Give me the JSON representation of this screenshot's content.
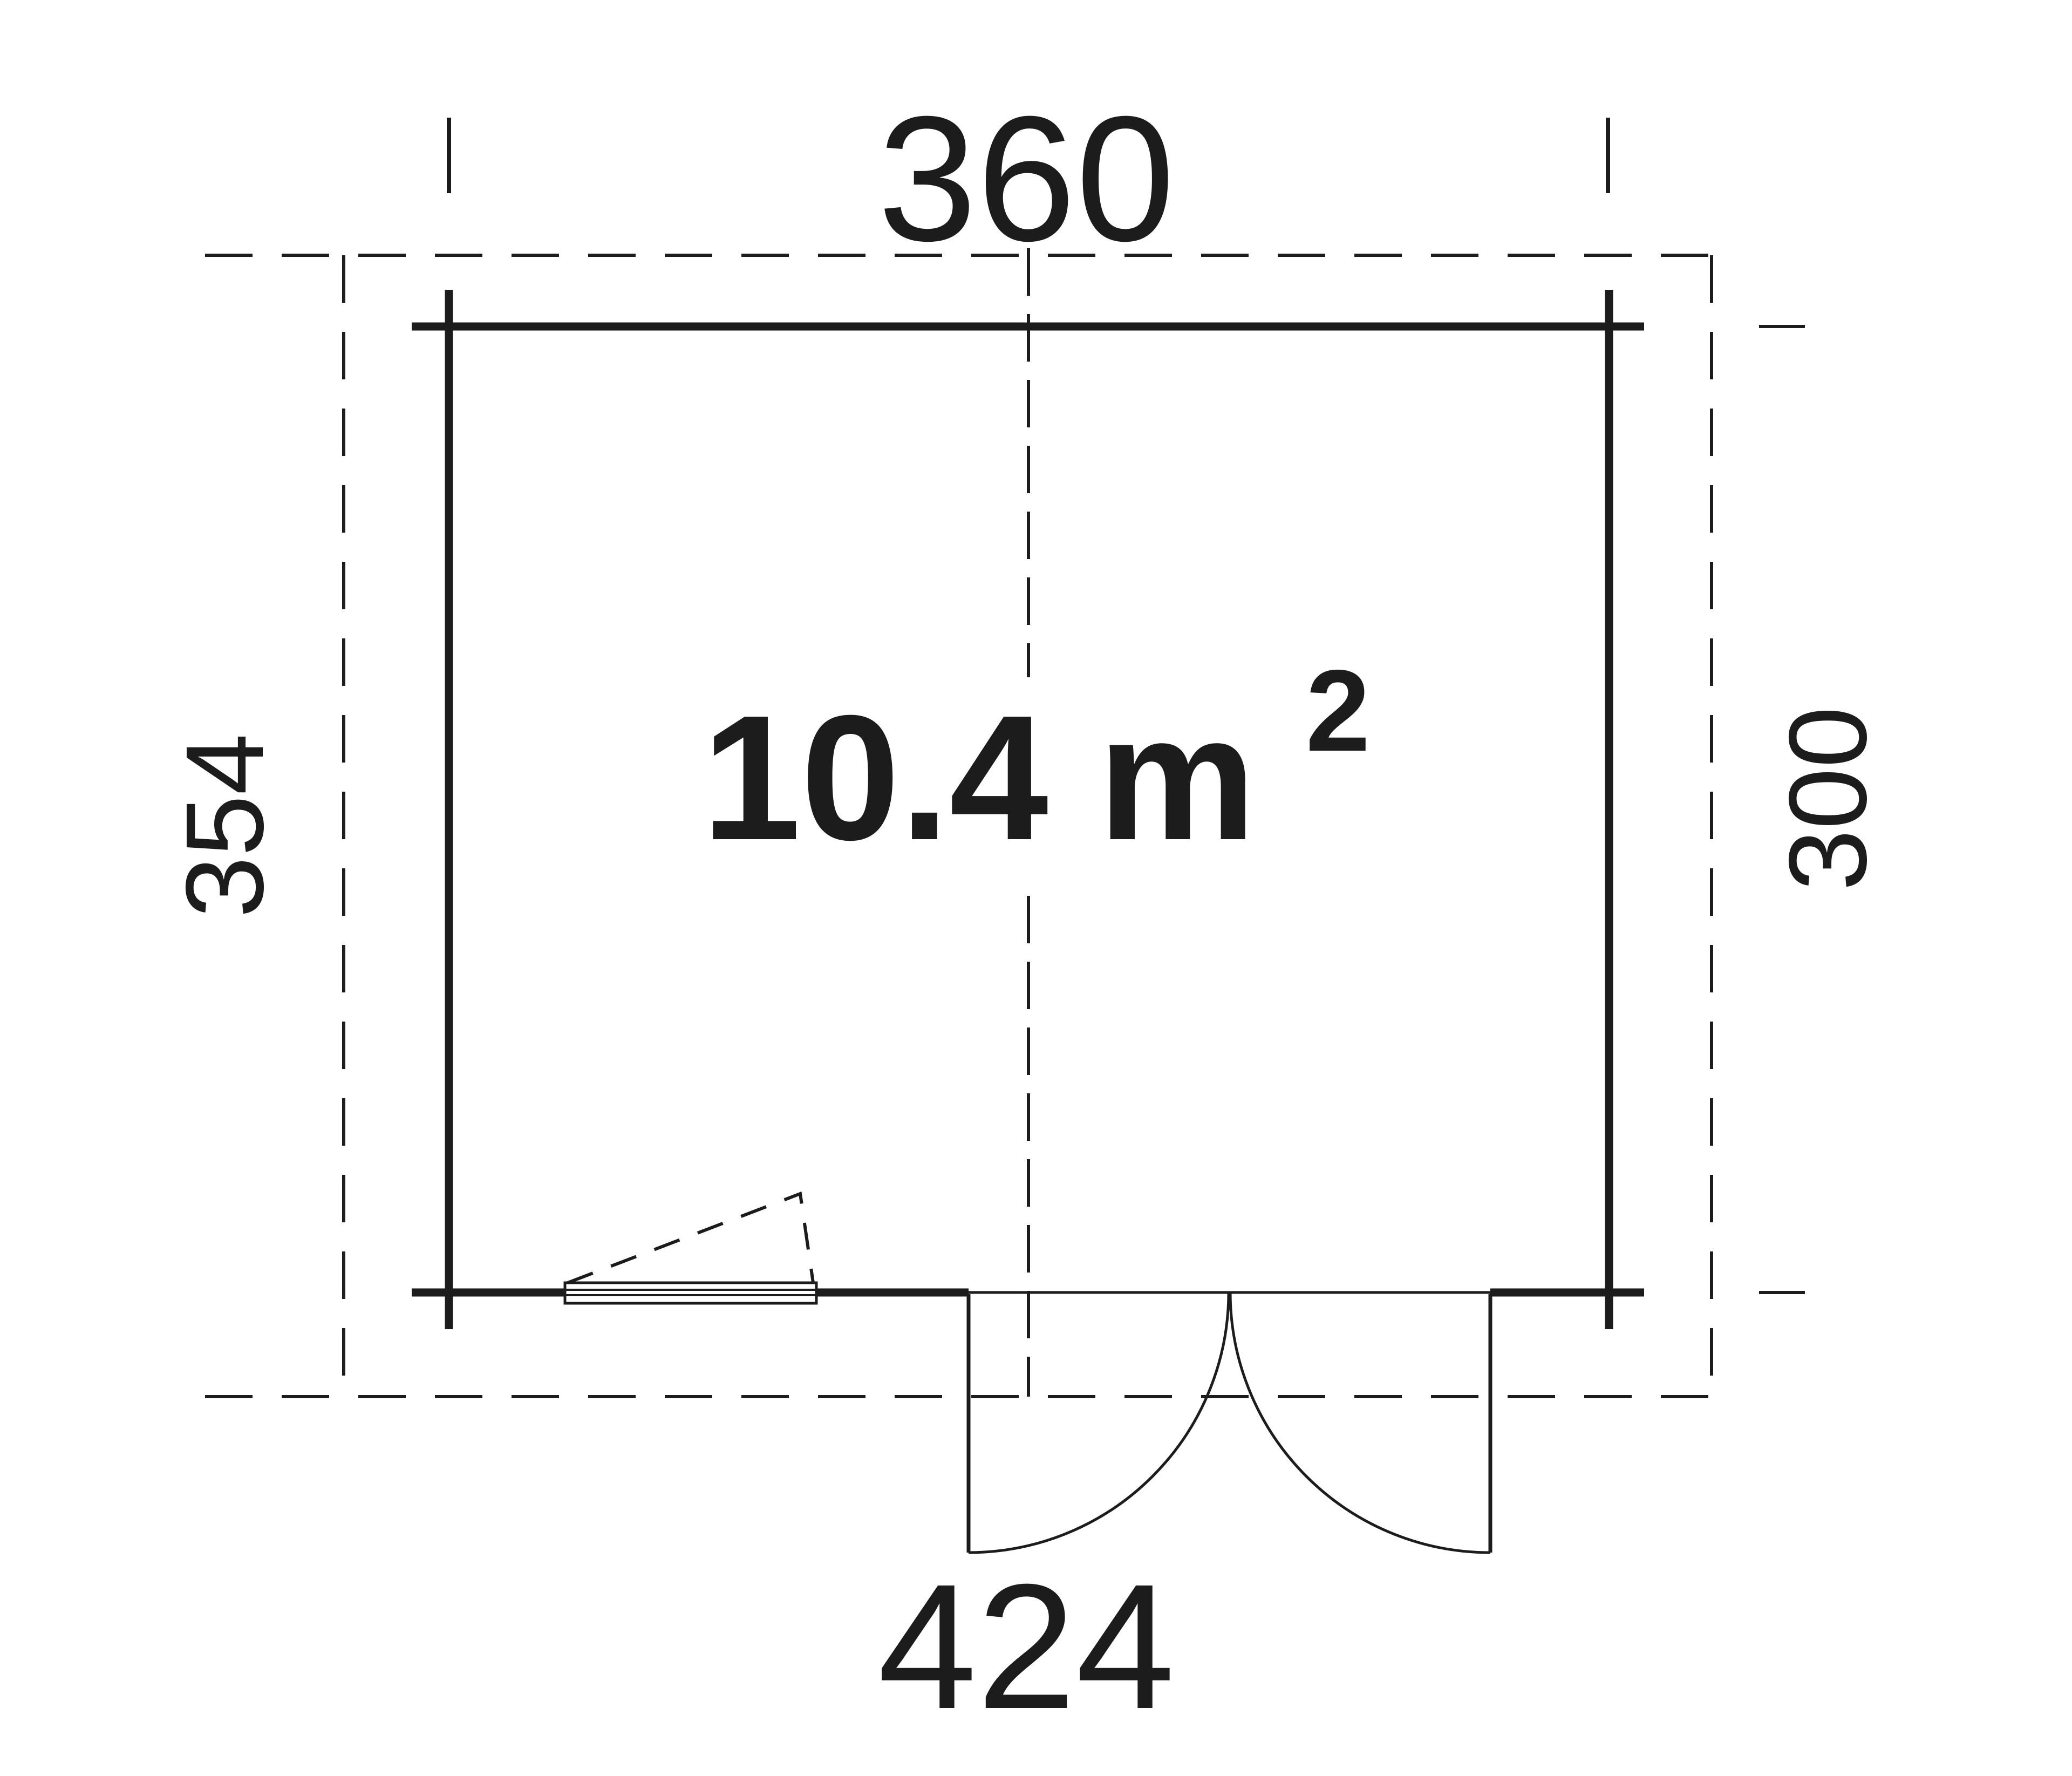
{
  "diagram": {
    "type": "floor-plan",
    "area": {
      "text": "10.4 m",
      "exponent": "2"
    },
    "dimensions": {
      "top": {
        "label": "360"
      },
      "bottom": {
        "label": "424"
      },
      "left": {
        "label": "354"
      },
      "right": {
        "label": "300"
      }
    },
    "colors": {
      "ink": "#1c1c1c",
      "background": "#ffffff"
    }
  }
}
